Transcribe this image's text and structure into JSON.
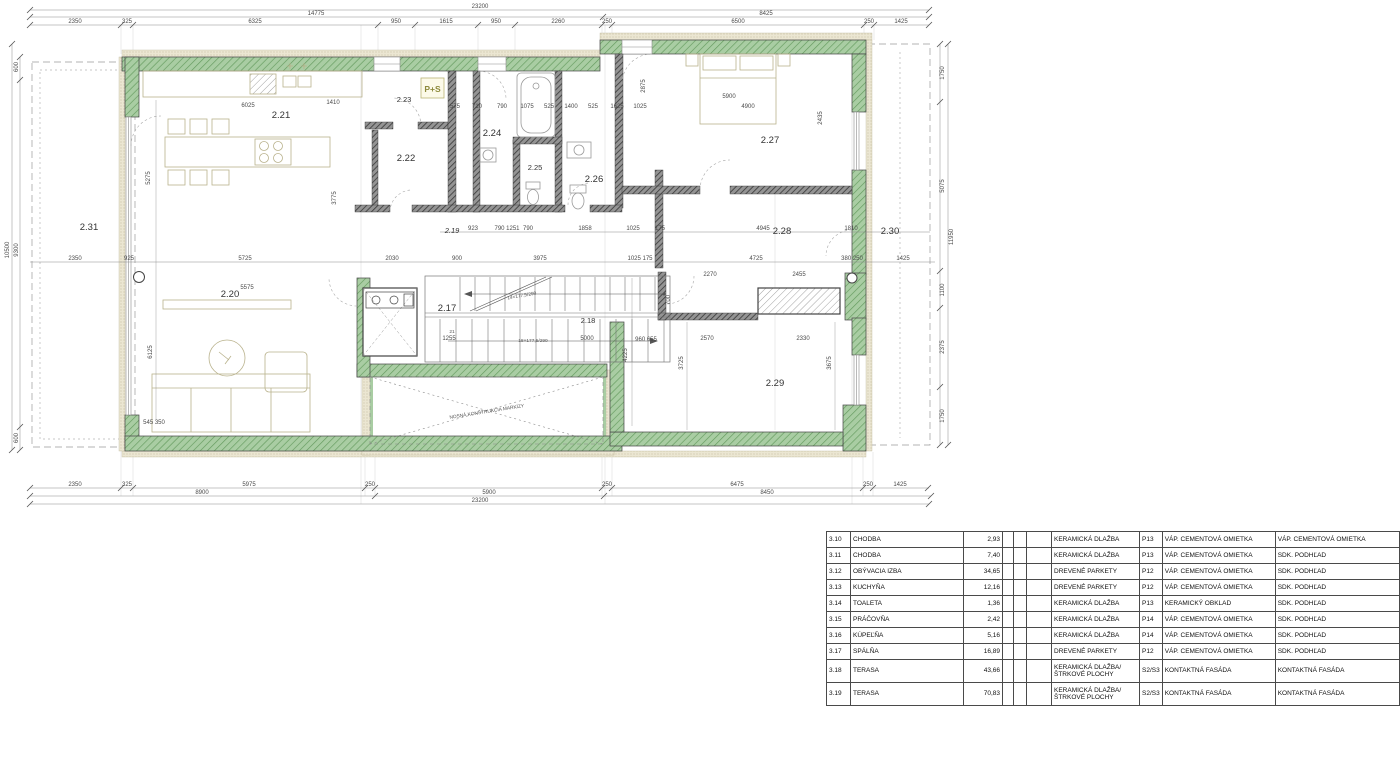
{
  "plan": {
    "rooms": {
      "r217": "2.17",
      "r218": "2.18",
      "r219": "2.19",
      "r220": "2.20",
      "r221": "2.21",
      "r222": "2.22",
      "r223": "2.23",
      "r224": "2.24",
      "r225": "2.25",
      "r226": "2.26",
      "r227": "2.27",
      "r228": "2.28",
      "r229": "2.29",
      "r230": "2.30",
      "r231": "2.31"
    },
    "badge_ps": "P+S",
    "stair_note_up": "14×177,5/290",
    "stair_note_down": "18×177,5/290",
    "stair_step": "21",
    "awning_note": "NOSNÁ KONŠTRUKCIA MARKÍZY",
    "dims": {
      "top1": [
        "23200"
      ],
      "top2": [
        "14775",
        "8425"
      ],
      "top3": [
        "2350",
        "325",
        "6325",
        "950",
        "1615",
        "950",
        "2260",
        "250",
        "6500",
        "250",
        "1425"
      ],
      "mid": [
        "923",
        "790 1251",
        "790",
        "1858",
        "1025",
        "175",
        "4945",
        "1810"
      ],
      "row262": [
        "2350",
        "925",
        "5725",
        "2030",
        "900",
        "3975",
        "1025 175",
        "4725",
        "380 250",
        "1425"
      ],
      "bath_row": [
        "575",
        "710",
        "790",
        "1075",
        "525",
        "1400",
        "525",
        "1625",
        "1025"
      ],
      "bot1": [
        "2350",
        "325",
        "5975",
        "250",
        "250",
        "6475",
        "250",
        "1425"
      ],
      "bot2": [
        "8900",
        "5900",
        "8450"
      ],
      "bot3": [
        "23200"
      ],
      "left": [
        "600",
        "10500",
        "9300",
        "600"
      ],
      "right": [
        "1750",
        "5075",
        "11950",
        "1100",
        "2375",
        "1750"
      ],
      "inner_h": [
        "6025",
        "1410",
        "5900",
        "4900",
        "5575",
        "2270",
        "2455",
        "2570",
        "2330",
        "5000",
        "1255",
        "960 655",
        "545 350"
      ],
      "inner_v": [
        "5275",
        "3775",
        "6125",
        "4225",
        "2875",
        "2435",
        "3725",
        "3675",
        "700"
      ]
    }
  },
  "legend": {
    "rows": [
      {
        "id": "3.10",
        "name": "CHODBA",
        "area": "2,93",
        "floor": "KERAMICKÁ DLAŽBA",
        "code": "P13",
        "wall": "VÁP. CEMENTOVÁ OMIETKA",
        "ceiling": "VÁP. CEMENTOVÁ OMIETKA"
      },
      {
        "id": "3.11",
        "name": "CHODBA",
        "area": "7,40",
        "floor": "KERAMICKÁ DLAŽBA",
        "code": "P13",
        "wall": "VÁP. CEMENTOVÁ OMIETKA",
        "ceiling": "SDK. PODHĽAD"
      },
      {
        "id": "3.12",
        "name": "OBÝVACIA IZBA",
        "area": "34,65",
        "floor": "DREVENÉ PARKETY",
        "code": "P12",
        "wall": "VÁP. CEMENTOVÁ OMIETKA",
        "ceiling": "SDK. PODHĽAD"
      },
      {
        "id": "3.13",
        "name": "KUCHYŇA",
        "area": "12,16",
        "floor": "DREVENÉ PARKETY",
        "code": "P12",
        "wall": "VÁP. CEMENTOVÁ OMIETKA",
        "ceiling": "SDK. PODHĽAD"
      },
      {
        "id": "3.14",
        "name": "TOALETA",
        "area": "1,36",
        "floor": "KERAMICKÁ DLAŽBA",
        "code": "P13",
        "wall": "KERAMICKÝ OBKLAD",
        "ceiling": "SDK. PODHĽAD"
      },
      {
        "id": "3.15",
        "name": "PRÁČOVŇA",
        "area": "2,42",
        "floor": "KERAMICKÁ DLAŽBA",
        "code": "P14",
        "wall": "VÁP. CEMENTOVÁ OMIETKA",
        "ceiling": "SDK. PODHĽAD"
      },
      {
        "id": "3.16",
        "name": "KÚPEĽŇA",
        "area": "5,16",
        "floor": "KERAMICKÁ DLAŽBA",
        "code": "P14",
        "wall": "VÁP. CEMENTOVÁ OMIETKA",
        "ceiling": "SDK. PODHĽAD"
      },
      {
        "id": "3.17",
        "name": "SPÁLŇA",
        "area": "16,89",
        "floor": "DREVENÉ PARKETY",
        "code": "P12",
        "wall": "VÁP. CEMENTOVÁ OMIETKA",
        "ceiling": "SDK. PODHĽAD"
      },
      {
        "id": "3.18",
        "name": "TERASA",
        "area": "43,66",
        "floor": "KERAMICKÁ DLAŽBA/ŠTRKOVÉ PLOCHY",
        "code": "S2/S3",
        "wall": "KONTAKTNÁ FASÁDA",
        "ceiling": "KONTAKTNÁ FASÁDA"
      },
      {
        "id": "3.19",
        "name": "TERASA",
        "area": "70,83",
        "floor": "KERAMICKÁ DLAŽBA/ŠTRKOVÉ PLOCHY",
        "code": "S2/S3",
        "wall": "KONTAKTNÁ FASÁDA",
        "ceiling": "KONTAKTNÁ FASÁDA"
      }
    ]
  }
}
